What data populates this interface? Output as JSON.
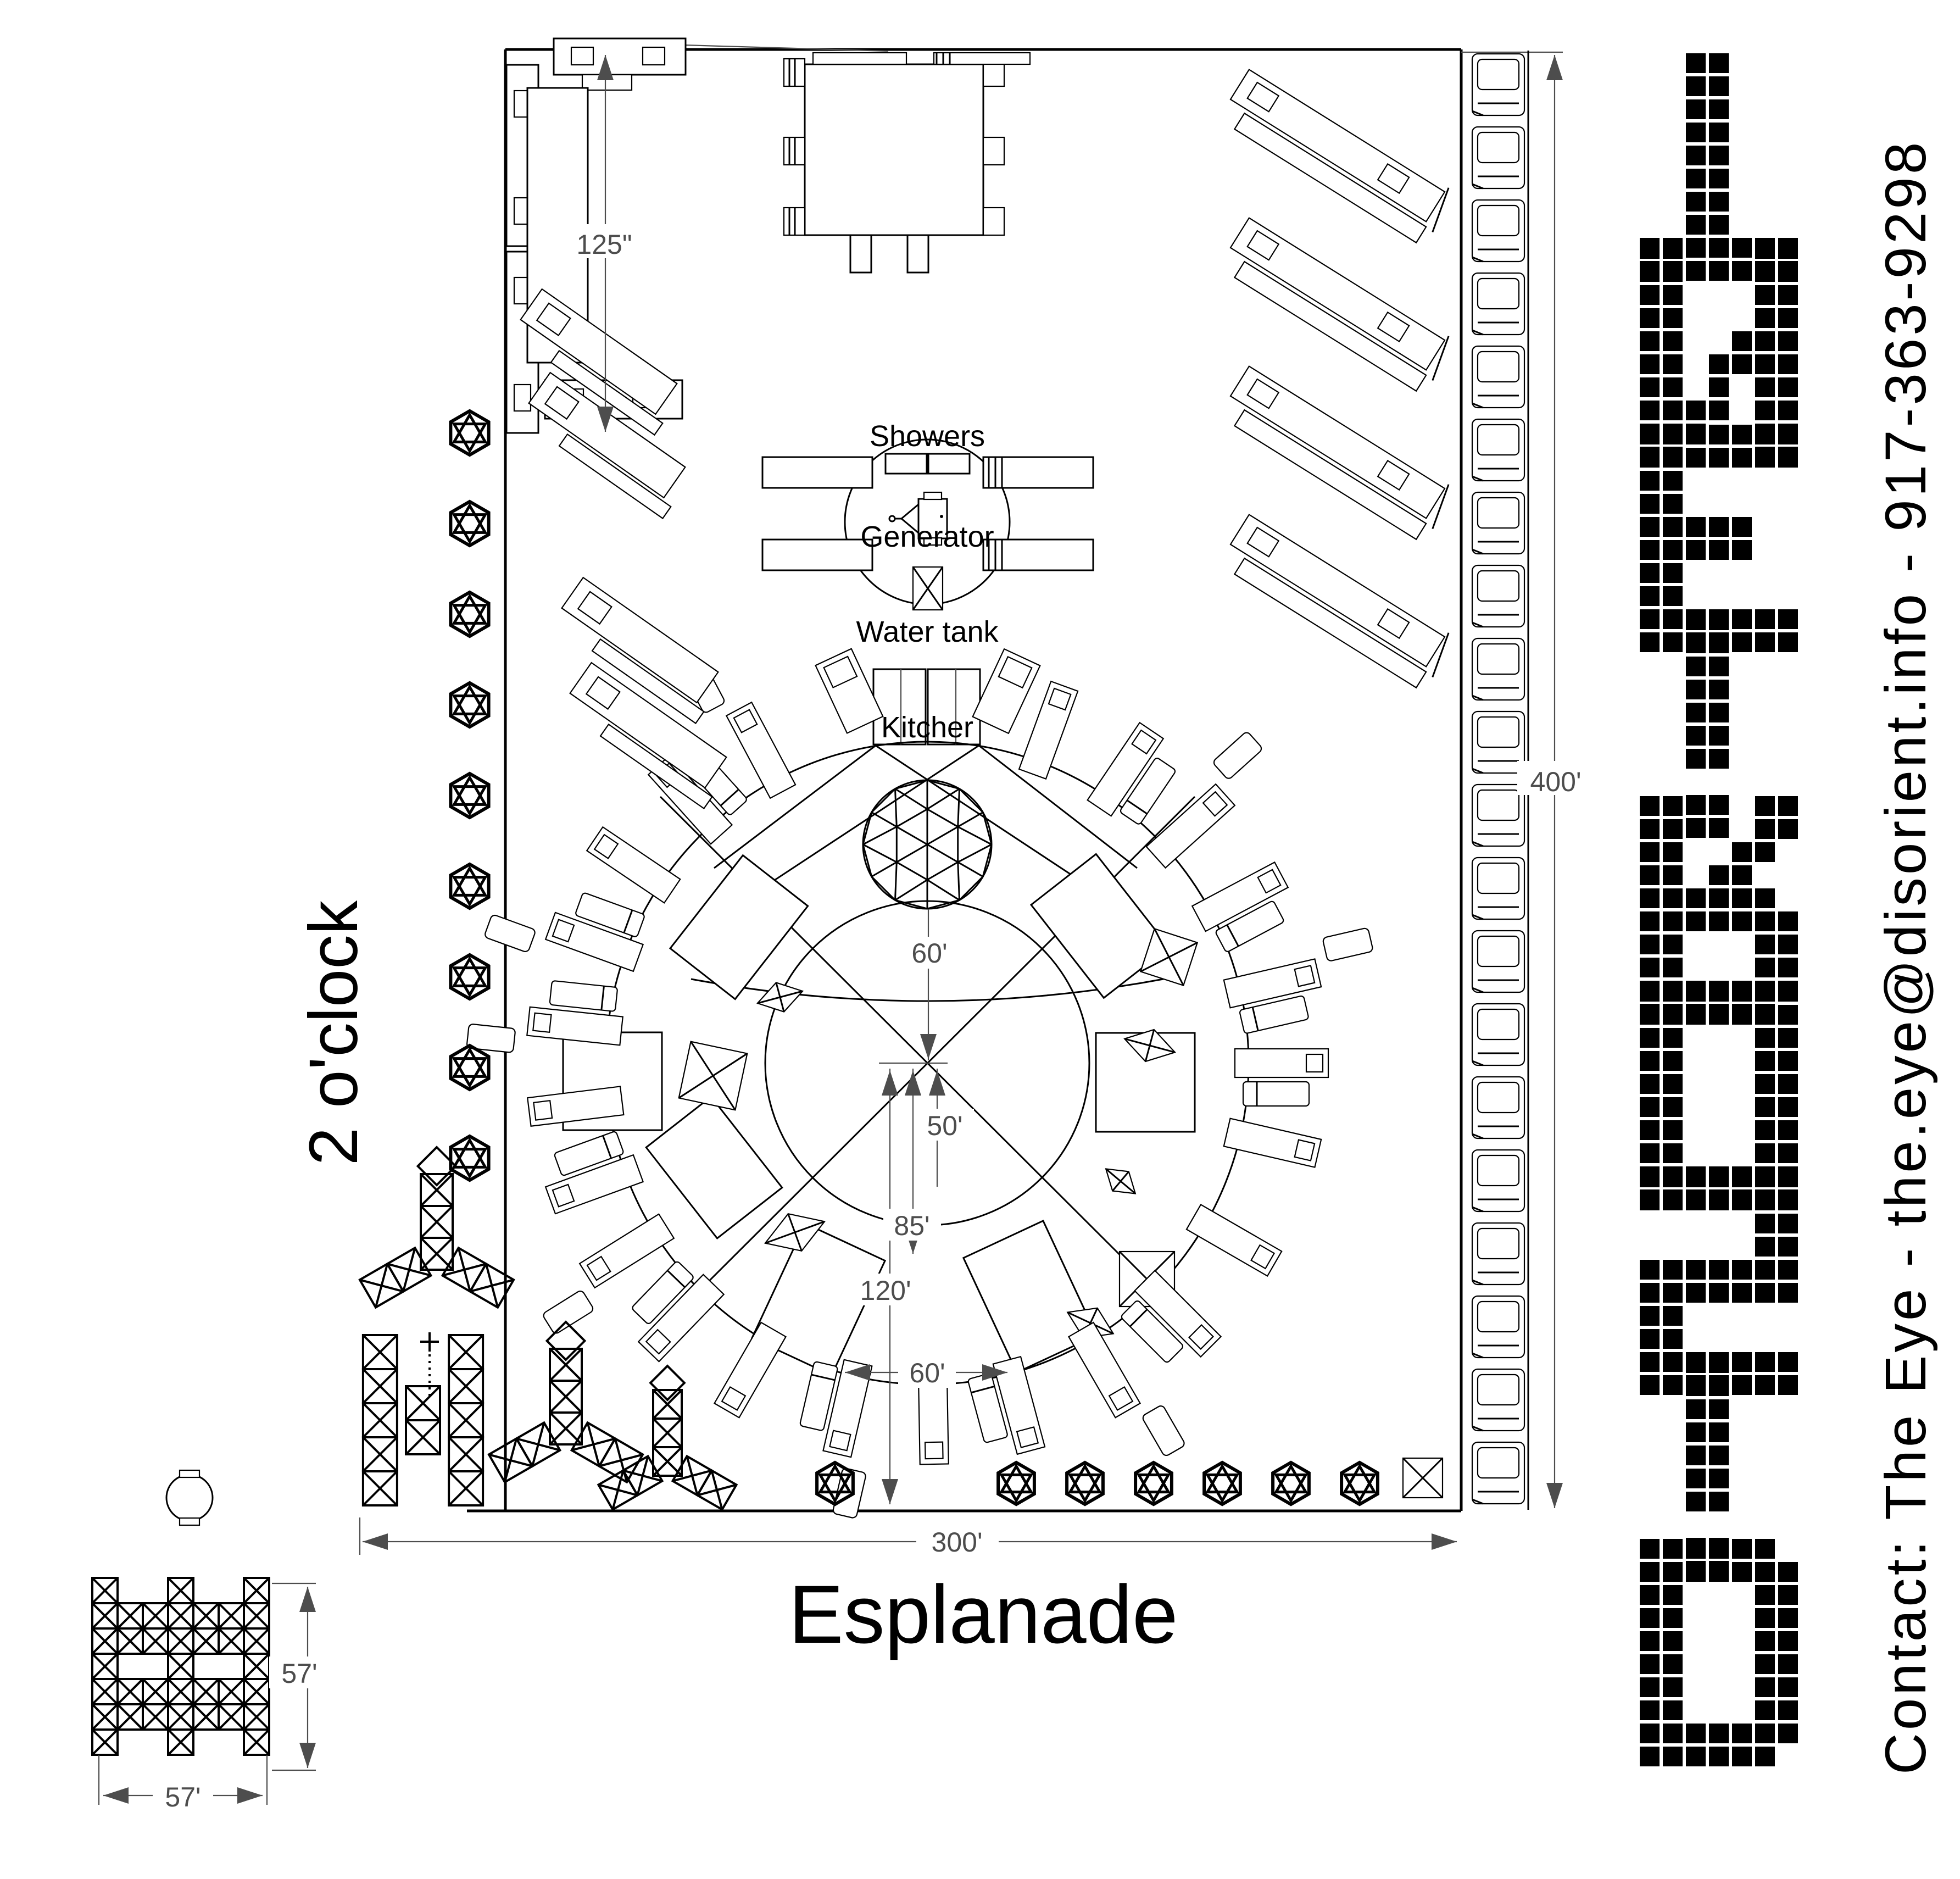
{
  "page": {
    "background": "#ffffff"
  },
  "logo": {
    "text": "DiSORiENT"
  },
  "contact": {
    "text": "Contact: The Eye - the.eye@disorient.info - 917-363-9298"
  },
  "streets": {
    "left": "2 o'clock",
    "bottom": "Esplanade"
  },
  "facilities": {
    "showers": "Showers",
    "generator": "Generator",
    "water_tank": "Water tank",
    "kitchen": "Kitcher"
  },
  "dimensions": {
    "stage_offset": "125\"",
    "plot_height": "400'",
    "plot_width": "300'",
    "dome_to_center": "60'",
    "center_radius": "50'",
    "inner_radius": "85'",
    "outer_radius": "120'",
    "ring_gap": "60'",
    "truss_width": "57'",
    "truss_height": "57'"
  },
  "colors": {
    "ink": "#000000",
    "dimension": "#4d4d4d",
    "background": "#ffffff"
  }
}
